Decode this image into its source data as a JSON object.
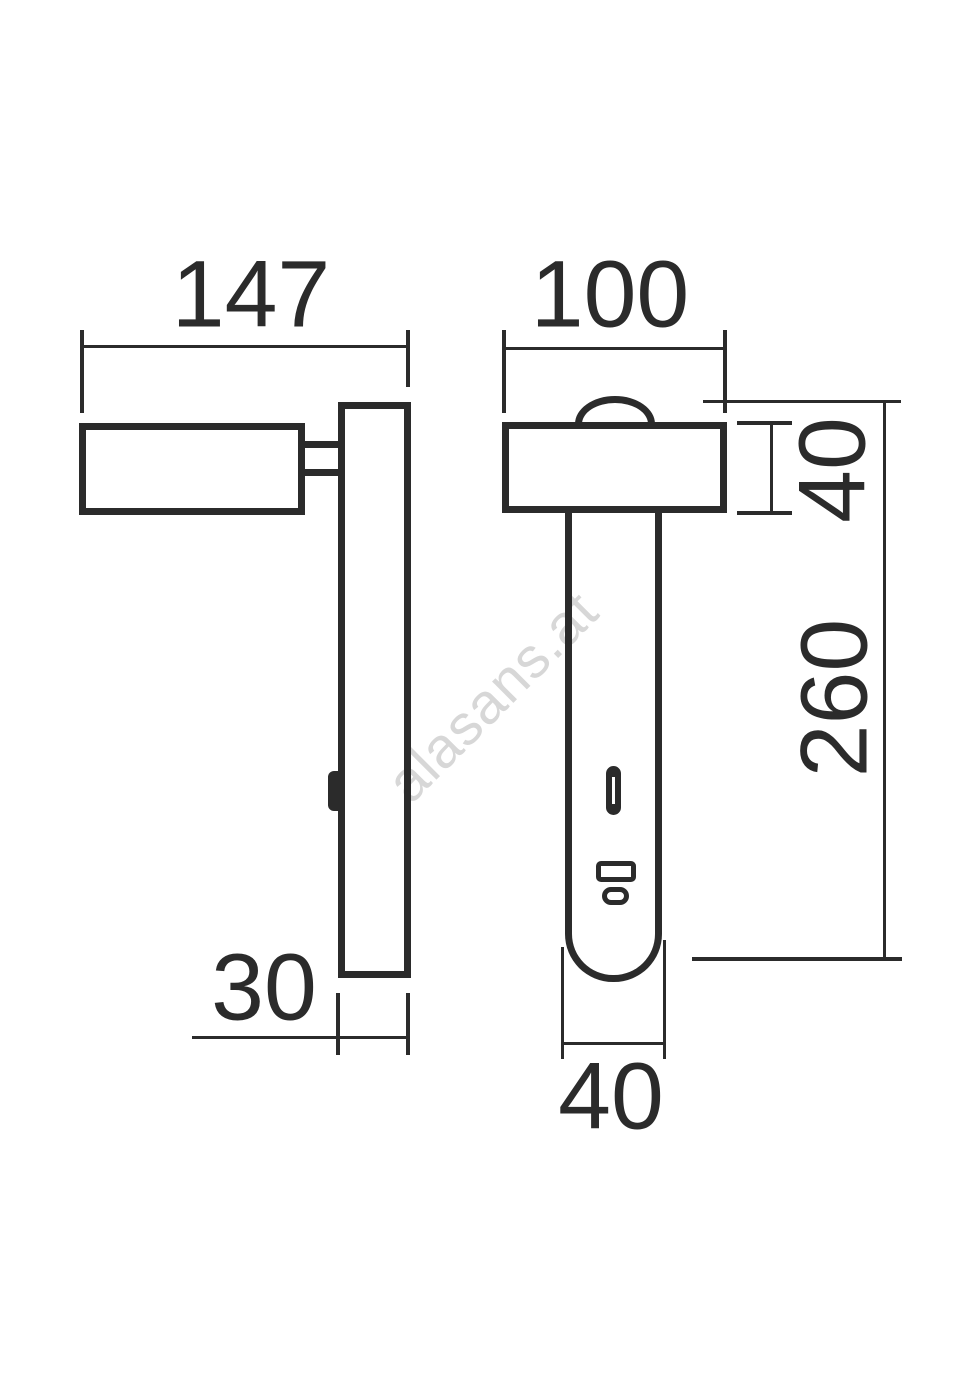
{
  "drawing": {
    "type": "dimensioned technical drawing of a wall reading lamp (side view and front view)",
    "colors": {
      "line": "#2b2b2b",
      "watermark": "#d7d7d7",
      "background": "#ffffff"
    },
    "dims": {
      "side_width": "147",
      "front_width": "100",
      "head_height": "40",
      "body_height": "260",
      "plate_depth": "30",
      "stem_width": "40"
    },
    "watermark": {
      "text": "alasans.at"
    }
  }
}
